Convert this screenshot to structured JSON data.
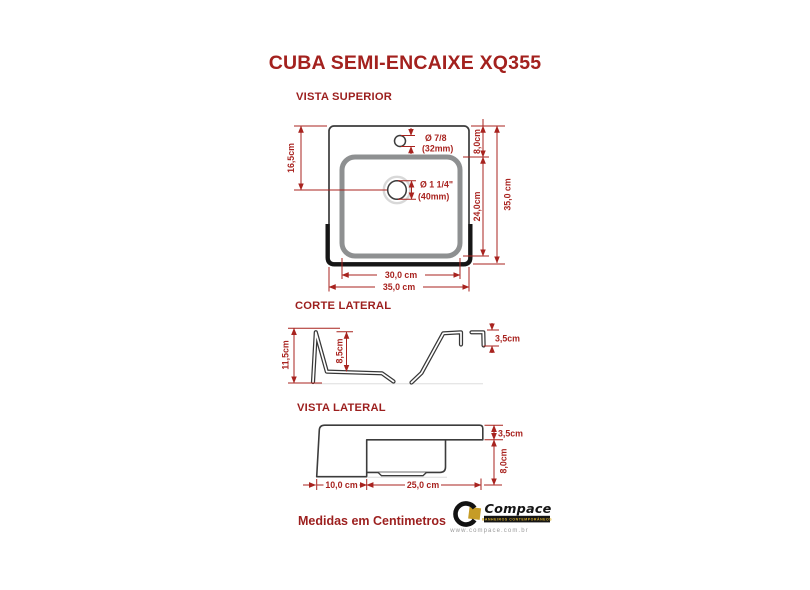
{
  "title": "CUBA SEMI-ENCAIXE XQ355",
  "footnote": "Medidas em Centimetros",
  "colors": {
    "accent_red": "#a8231f",
    "line_dark": "#3c3c3c",
    "thick_black": "#161616",
    "basin_gray": "#8e9091",
    "logo_gold": "#c69c26"
  },
  "vista_superior": {
    "label": "VISTA SUPERIOR",
    "dim_left_height": "16,5cm",
    "dim_top_offset": "8,0cm",
    "dim_basin_height": "24,0cm",
    "dim_total_height": "35,0 cm",
    "dim_basin_width": "30,0 cm",
    "dim_total_width": "35,0 cm",
    "faucet_hole_diameter": "Ø 7/8",
    "faucet_hole_mm": "(32mm)",
    "drain_diameter": "Ø 1 1/4\"",
    "drain_mm": "(40mm)"
  },
  "corte_lateral": {
    "label": "CORTE LATERAL",
    "dim_total_height": "11,5cm",
    "dim_inner_depth": "8,5cm",
    "dim_rim_height": "3,5cm"
  },
  "vista_lateral": {
    "label": "VISTA LATERAL",
    "dim_rim_height": "3,5cm",
    "dim_bowl_height": "8,0cm",
    "dim_front_depth": "10,0 cm",
    "dim_bowl_length": "25,0 cm"
  },
  "logo": {
    "brand": "Compace",
    "tagline": "BANHEIROS CONTEMPORÂNEOS",
    "url": "www.compace.com.br"
  }
}
